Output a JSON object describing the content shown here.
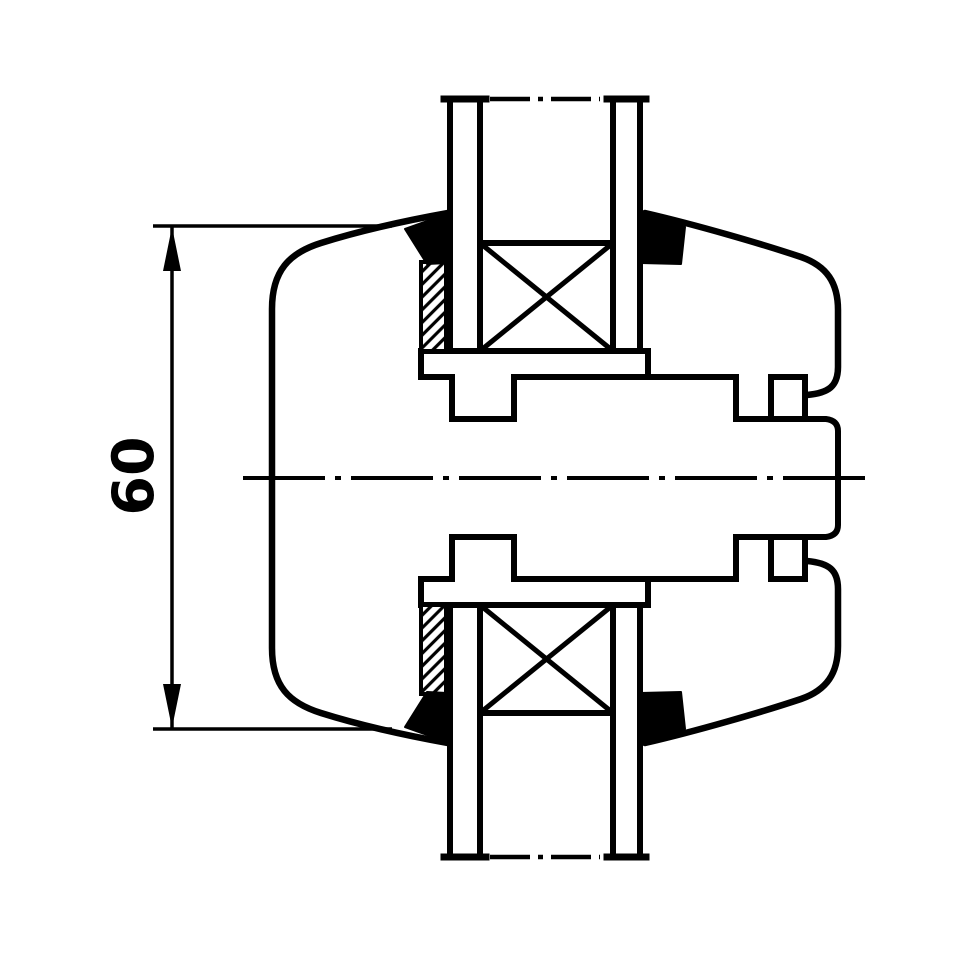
{
  "title": "coupling-section-technical-drawing",
  "colors": {
    "line": "#000000",
    "background": "#ffffff"
  },
  "dimension": {
    "label": "60",
    "text_x": 134,
    "text_y": 476,
    "font_size": 57,
    "rotation": -90,
    "dim_line": {
      "x1": 172,
      "y1": 226,
      "x2": 172,
      "y2": 729,
      "w": 3.5
    },
    "ext_lines": [
      {
        "name": "extension-line-top",
        "x1": 153,
        "y1": 226,
        "x2": 392,
        "y2": 226,
        "w": 3.5
      },
      {
        "name": "extension-line-bottom",
        "x1": 153,
        "y1": 729,
        "x2": 392,
        "y2": 729,
        "w": 3.5
      }
    ],
    "arrows": [
      {
        "name": "dim-arrow-up",
        "points": "172,227 163,271 181,271"
      },
      {
        "name": "dim-arrow-down",
        "points": "172,728 163,684 181,684"
      }
    ]
  },
  "drawing": {
    "width": 960,
    "height": 960,
    "paths": [
      {
        "name": "housing-outline-left",
        "d": "M 448,213 C 398,222 356,232 321,243 C 289,253 272,271 272,309 L 272,648 C 272,686 289,703 321,713 C 356,724 398,734 448,743",
        "w": 6.5
      },
      {
        "name": "housing-outline-right-top",
        "d": "M 645,213 C 697,225 762,244 801,257 C 827,266 838,283 838,310 L 838,367 C 838,386 829,393 807,395",
        "w": 6.5
      },
      {
        "name": "housing-outline-right-bottom",
        "d": "M 807,561 C 829,563 838,570 838,589 L 838,646 C 838,673 827,690 801,699 C 762,712 697,731 645,743",
        "w": 6.5
      },
      {
        "name": "hub-flange-band-top",
        "d": "M 421,377 L 421,351 L 648,351 L 648,377",
        "w": 6
      },
      {
        "name": "hub-flange-band-bottom",
        "d": "M 421,579 L 421,605 L 648,605 L 648,579",
        "w": 6
      },
      {
        "name": "shaft-end-recess",
        "d": "M 736,419 L 826,419 C 834,420 838,424 838,431 L 838,525 C 838,532 834,536 826,537 L 736,537",
        "w": 6
      }
    ],
    "lines": [
      {
        "name": "hub-surface-top-1",
        "x1": 421,
        "y1": 377,
        "x2": 452,
        "y2": 377,
        "w": 6
      },
      {
        "name": "hub-surface-top-2",
        "x1": 514,
        "y1": 377,
        "x2": 736,
        "y2": 377,
        "w": 6
      },
      {
        "name": "hub-surface-top-3",
        "x1": 771,
        "y1": 377,
        "x2": 805,
        "y2": 377,
        "w": 6
      },
      {
        "name": "groove-left-top-left-wall",
        "x1": 452,
        "y1": 377,
        "x2": 452,
        "y2": 419,
        "w": 6
      },
      {
        "name": "groove-left-top-right-wall",
        "x1": 514,
        "y1": 377,
        "x2": 514,
        "y2": 419,
        "w": 6
      },
      {
        "name": "groove-left-top-bottom",
        "x1": 452,
        "y1": 419,
        "x2": 514,
        "y2": 419,
        "w": 6
      },
      {
        "name": "groove-right-top-left-wall",
        "x1": 736,
        "y1": 377,
        "x2": 736,
        "y2": 419,
        "w": 6
      },
      {
        "name": "groove-right-top-right-wall",
        "x1": 771,
        "y1": 377,
        "x2": 771,
        "y2": 419,
        "w": 6
      },
      {
        "name": "hub-end-face-top",
        "x1": 805,
        "y1": 377,
        "x2": 805,
        "y2": 419,
        "w": 6
      },
      {
        "name": "hub-surface-bottom-1",
        "x1": 421,
        "y1": 579,
        "x2": 452,
        "y2": 579,
        "w": 6
      },
      {
        "name": "hub-surface-bottom-2",
        "x1": 514,
        "y1": 579,
        "x2": 736,
        "y2": 579,
        "w": 6
      },
      {
        "name": "hub-surface-bottom-3",
        "x1": 771,
        "y1": 579,
        "x2": 805,
        "y2": 579,
        "w": 6
      },
      {
        "name": "groove-left-bottom-left-wall",
        "x1": 452,
        "y1": 537,
        "x2": 452,
        "y2": 579,
        "w": 6
      },
      {
        "name": "groove-left-bottom-right-wall",
        "x1": 514,
        "y1": 537,
        "x2": 514,
        "y2": 579,
        "w": 6
      },
      {
        "name": "groove-left-bottom-top",
        "x1": 452,
        "y1": 537,
        "x2": 514,
        "y2": 537,
        "w": 6
      },
      {
        "name": "groove-right-bottom-left-wall",
        "x1": 736,
        "y1": 537,
        "x2": 736,
        "y2": 579,
        "w": 6
      },
      {
        "name": "groove-right-bottom-right-wall",
        "x1": 771,
        "y1": 537,
        "x2": 771,
        "y2": 579,
        "w": 6
      },
      {
        "name": "hub-end-face-bottom",
        "x1": 805,
        "y1": 537,
        "x2": 805,
        "y2": 579,
        "w": 6
      },
      {
        "name": "pipe-top-outer-left",
        "x1": 450,
        "y1": 99,
        "x2": 450,
        "y2": 351,
        "w": 6
      },
      {
        "name": "pipe-top-inner-left",
        "x1": 480,
        "y1": 99,
        "x2": 480,
        "y2": 351,
        "w": 6
      },
      {
        "name": "pipe-top-inner-right",
        "x1": 613,
        "y1": 99,
        "x2": 613,
        "y2": 351,
        "w": 6
      },
      {
        "name": "pipe-top-outer-right",
        "x1": 640,
        "y1": 99,
        "x2": 640,
        "y2": 351,
        "w": 6
      },
      {
        "name": "pipe-top-foot-left",
        "x1": 444,
        "y1": 99,
        "x2": 486,
        "y2": 99,
        "w": 7
      },
      {
        "name": "pipe-top-foot-right",
        "x1": 607,
        "y1": 99,
        "x2": 646,
        "y2": 99,
        "w": 7
      },
      {
        "name": "pipe-bottom-outer-left",
        "x1": 450,
        "y1": 605,
        "x2": 450,
        "y2": 857,
        "w": 6
      },
      {
        "name": "pipe-bottom-inner-left",
        "x1": 480,
        "y1": 605,
        "x2": 480,
        "y2": 857,
        "w": 6
      },
      {
        "name": "pipe-bottom-inner-right",
        "x1": 613,
        "y1": 605,
        "x2": 613,
        "y2": 857,
        "w": 6
      },
      {
        "name": "pipe-bottom-outer-right",
        "x1": 640,
        "y1": 605,
        "x2": 640,
        "y2": 857,
        "w": 6
      },
      {
        "name": "pipe-bottom-foot-left",
        "x1": 444,
        "y1": 857,
        "x2": 486,
        "y2": 857,
        "w": 7
      },
      {
        "name": "pipe-bottom-foot-right",
        "x1": 607,
        "y1": 857,
        "x2": 646,
        "y2": 857,
        "w": 7
      }
    ],
    "dash_lines": [
      {
        "name": "main-centerline",
        "x1": 243,
        "y1": 478,
        "x2": 872,
        "y2": 478,
        "w": 4,
        "dash": "82 10 6 10"
      },
      {
        "name": "pipe-top-break-centerline",
        "x1": 490,
        "y1": 99,
        "x2": 600,
        "y2": 99,
        "w": 4.5,
        "dash": "40 8 5 8"
      },
      {
        "name": "pipe-bottom-break-centerline",
        "x1": 490,
        "y1": 857,
        "x2": 600,
        "y2": 857,
        "w": 4.5,
        "dash": "40 8 5 8"
      }
    ],
    "bearing_boxes": [
      {
        "name": "bearing-symbol-top",
        "x": 480,
        "y": 243,
        "w": 133,
        "h": 108
      },
      {
        "name": "bearing-symbol-bottom",
        "x": 480,
        "y": 605,
        "w": 133,
        "h": 108
      }
    ],
    "hatch_rects": [
      {
        "name": "seal-carrier-hatch-top",
        "x": 421,
        "y": 262,
        "w": 25,
        "h": 89
      },
      {
        "name": "seal-carrier-hatch-bottom",
        "x": 421,
        "y": 605,
        "w": 25,
        "h": 89
      }
    ],
    "polygons": [
      {
        "name": "seal-top-left",
        "points": "405,229 447,214 447,263 427,264"
      },
      {
        "name": "seal-top-right",
        "points": "641,214 685,227 681,264 641,263"
      },
      {
        "name": "seal-bottom-left",
        "points": "405,727 447,742 447,693 427,692"
      },
      {
        "name": "seal-bottom-right",
        "points": "641,742 685,729 681,692 641,693"
      }
    ]
  }
}
